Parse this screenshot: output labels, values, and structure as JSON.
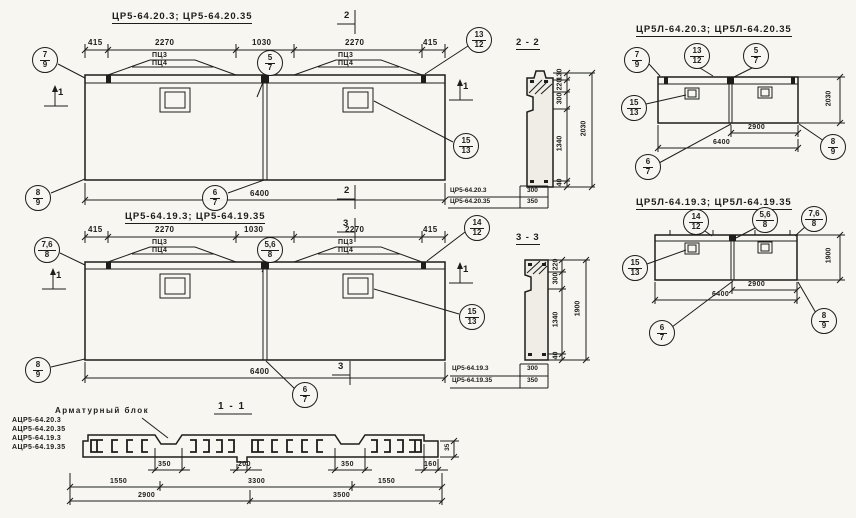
{
  "colors": {
    "paper": "#f7f6f1",
    "ink": "#1d1d1b"
  },
  "elevations": {
    "row1": {
      "title": "ЦР5-64.20.3;   ЦР5-64.20.35",
      "dims_top": [
        "415",
        "2270",
        "1030",
        "2270",
        "415"
      ],
      "dim_bottom": "6400",
      "mount_labels": [
        "ПЦ3",
        "ПЦ4"
      ],
      "markers": {
        "top": "2",
        "bottom": "2",
        "left": "1",
        "right": "1"
      },
      "balloons": {
        "top_left": {
          "top": "7",
          "bottom": "9"
        },
        "bottom_left": {
          "top": "8",
          "bottom": "9"
        },
        "joint_top": {
          "top": "5",
          "bottom": "7"
        },
        "top_right": {
          "top": "13",
          "bottom": "12"
        },
        "opening": {
          "top": "15",
          "bottom": "13"
        },
        "joint_bottom": {
          "top": "6",
          "bottom": "7"
        }
      }
    },
    "row2": {
      "title": "ЦР5-64.19.3;   ЦР5-64.19.35",
      "dims_top": [
        "415",
        "2270",
        "1030",
        "2270",
        "415"
      ],
      "dim_bottom": "6400",
      "mount_labels": [
        "ПЦ3",
        "ПЦ4"
      ],
      "markers": {
        "top": "3",
        "bottom": "3",
        "left": "1",
        "right": "1"
      },
      "balloons": {
        "top_left": {
          "top": "7,6",
          "bottom": "8"
        },
        "bottom_left": {
          "top": "8",
          "bottom": "9"
        },
        "joint_top": {
          "top": "5,6",
          "bottom": "8"
        },
        "top_right": {
          "top": "14",
          "bottom": "12"
        },
        "opening": {
          "top": "15",
          "bottom": "13"
        },
        "joint_bottom": {
          "top": "6",
          "bottom": "7"
        }
      }
    },
    "right1": {
      "title": "ЦР5Л-64.20.3;   ЦР5Л-64.20.35",
      "dim_joint": "2900",
      "dim_total": "6400",
      "dim_height": "2030",
      "balloons": {
        "top_left": {
          "top": "7",
          "bottom": "9"
        },
        "top_mid": {
          "top": "13",
          "bottom": "12"
        },
        "joint_top": {
          "top": "5",
          "bottom": "7"
        },
        "opening": {
          "top": "15",
          "bottom": "13"
        },
        "joint_bottom": {
          "top": "6",
          "bottom": "7"
        },
        "bottom_right": {
          "top": "8",
          "bottom": "9"
        }
      }
    },
    "right2": {
      "title": "ЦР5Л-64.19.3;   ЦР5Л-64.19.35",
      "dim_joint": "2900",
      "dim_total": "6400",
      "dim_height": "1900",
      "balloons": {
        "top_mid": {
          "top": "14",
          "bottom": "12"
        },
        "joint_top": {
          "top": "5,6",
          "bottom": "8"
        },
        "top_right": {
          "top": "7,6",
          "bottom": "8"
        },
        "opening": {
          "top": "15",
          "bottom": "13"
        },
        "joint_bottom": {
          "top": "6",
          "bottom": "7"
        },
        "bottom_right": {
          "top": "8",
          "bottom": "9"
        }
      }
    }
  },
  "sections": {
    "s22": {
      "title": "2 - 2",
      "chain": [
        "130",
        "220",
        "300",
        "1340",
        "40"
      ],
      "total": "2030",
      "table": [
        {
          "mark": "ЦР5-64.20.3",
          "value": "300"
        },
        {
          "mark": "ЦР5-64.20.35",
          "value": "350"
        }
      ]
    },
    "s33": {
      "title": "3 - 3",
      "chain": [
        "220",
        "300",
        "1340",
        "40"
      ],
      "total": "1900",
      "table": [
        {
          "mark": "ЦР5-64.19.3",
          "value": "300"
        },
        {
          "mark": "ЦР5-64.19.35",
          "value": "350"
        }
      ]
    },
    "s11": {
      "title": "1 - 1",
      "dims_notch": [
        "350",
        "200",
        "350",
        "160"
      ],
      "dim_edge": "35",
      "dims_mid": [
        "1550",
        "3300",
        "1550"
      ],
      "dims_total": [
        "2900",
        "3500"
      ]
    }
  },
  "rebar_block": {
    "label": "Арматурный блок",
    "items": [
      "АЦР5-64.20.3",
      "АЦР5-64.20.35",
      "АЦР5-64.19.3",
      "АЦР5-64.19.35"
    ]
  }
}
